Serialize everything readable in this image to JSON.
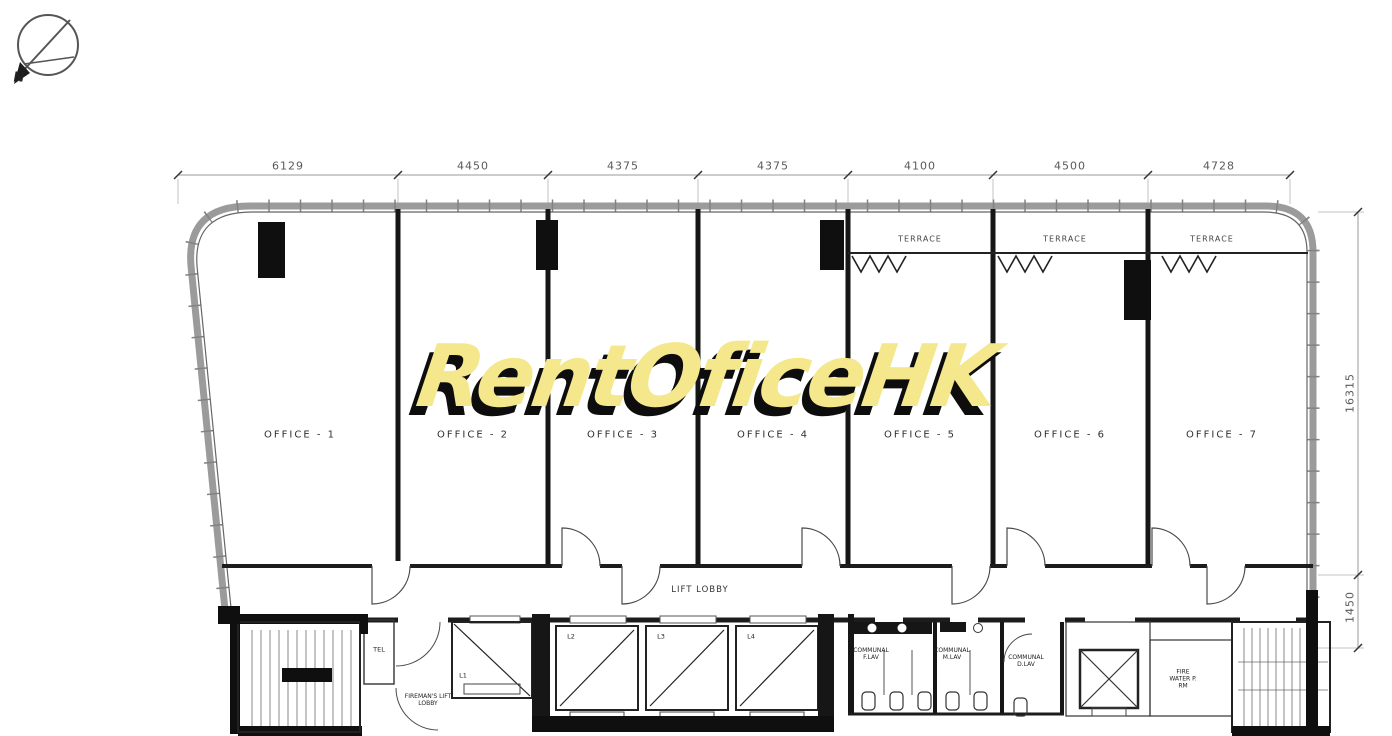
{
  "watermark": {
    "text": "RentOficeHK",
    "color": "#f4e78c",
    "shadow_color": "#0d0d0d"
  },
  "compass": {
    "north_label": "N"
  },
  "dimensions": {
    "top_mm": [
      "6129",
      "4450",
      "4375",
      "4375",
      "4100",
      "4500",
      "4728"
    ],
    "right_mm": [
      "16315",
      "1450"
    ]
  },
  "offices": [
    {
      "label": "OFFICE - 1"
    },
    {
      "label": "OFFICE - 2"
    },
    {
      "label": "OFFICE - 3"
    },
    {
      "label": "OFFICE - 4"
    },
    {
      "label": "OFFICE - 5"
    },
    {
      "label": "OFFICE - 6"
    },
    {
      "label": "OFFICE - 7"
    }
  ],
  "terraces": [
    {
      "label": "TERRACE"
    },
    {
      "label": "TERRACE"
    },
    {
      "label": "TERRACE"
    }
  ],
  "core": {
    "lift_lobby_label": "LIFT LOBBY",
    "fireman_lift_lobby_label": "FIREMAN'S LIFT LOBBY",
    "tel_room_label": "TEL",
    "lifts": [
      {
        "label": "L1"
      },
      {
        "label": "L2"
      },
      {
        "label": "L3"
      },
      {
        "label": "L4"
      }
    ],
    "toilets": [
      {
        "label": "COMMUNAL F.LAV"
      },
      {
        "label": "COMMUNAL M.LAV"
      },
      {
        "label": "COMMUNAL D.LAV"
      }
    ],
    "pump_room_label": "FIRE WATER P. RM"
  },
  "colors": {
    "wall": "#161616",
    "outline": "#999999",
    "background": "#ffffff"
  }
}
